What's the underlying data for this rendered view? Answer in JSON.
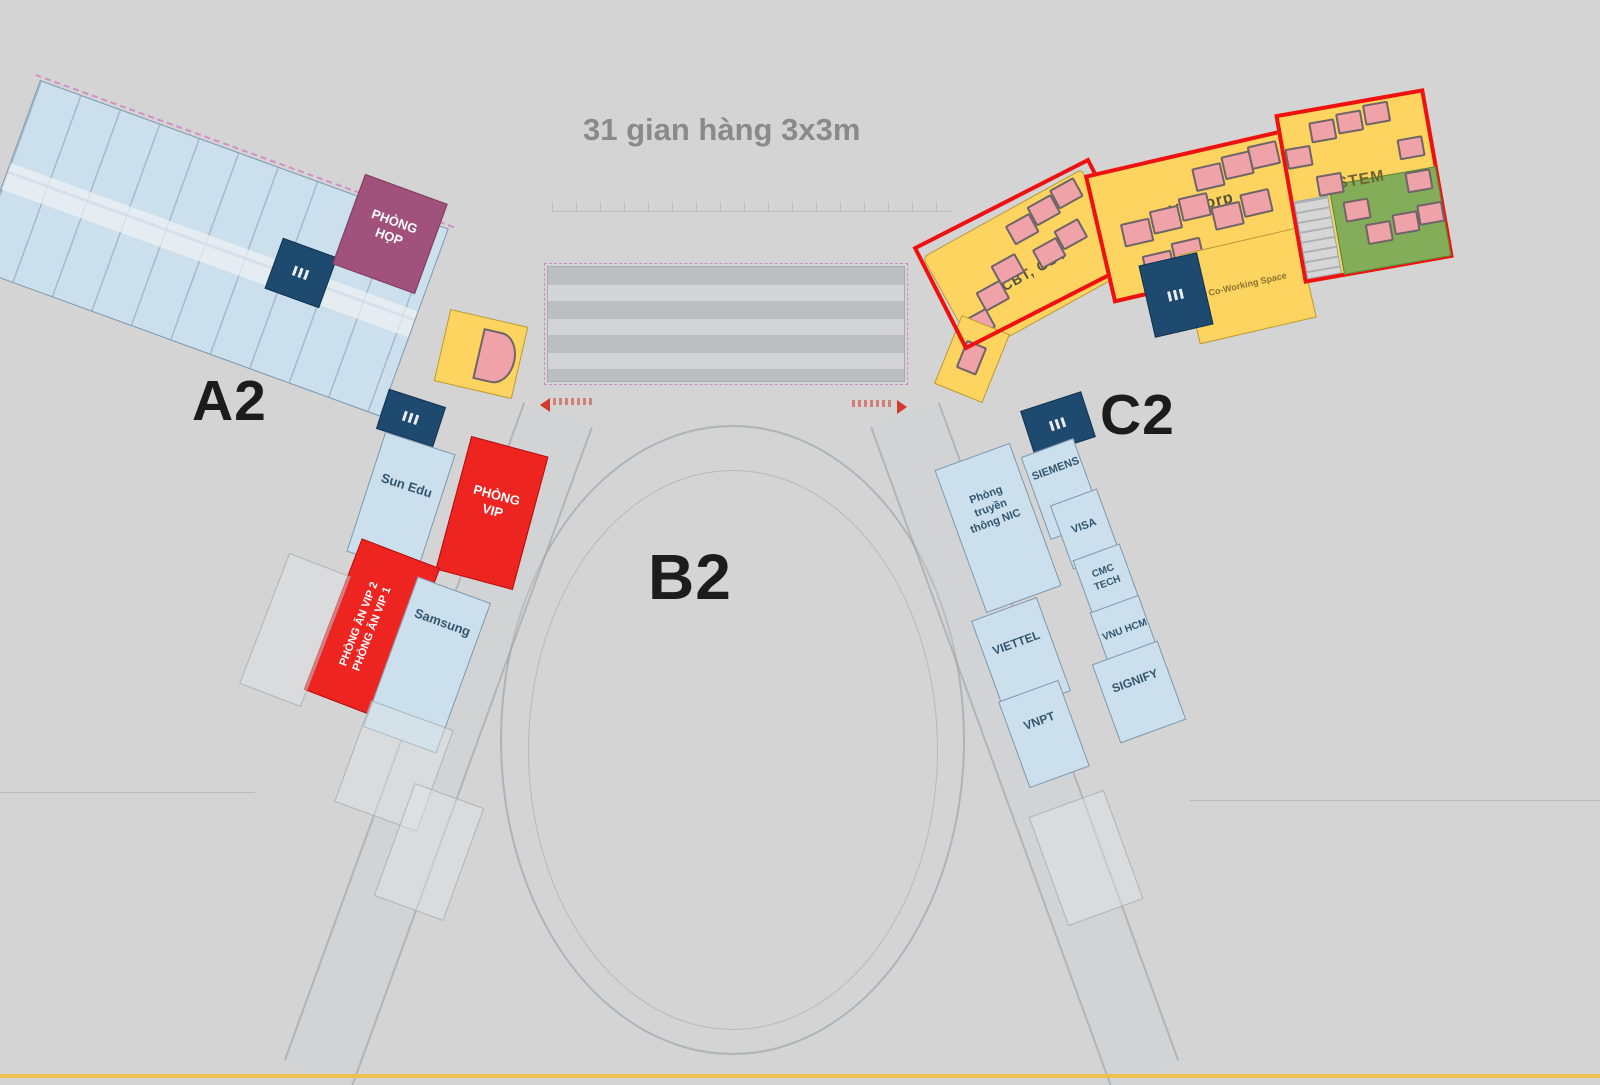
{
  "title": "31 gian hàng 3x3m",
  "zone_labels": {
    "a2": "A2",
    "b2": "B2",
    "c2": "C2"
  },
  "left_wing": {
    "phong_hop": "PHÒNG\nHỌP",
    "sun_edu": "Sun Edu",
    "phong_vip": "PHÒNG\nVIP",
    "phong_an_vip_line1": "PHÒNG ĂN VIP 2",
    "phong_an_vip_line2": "PHÒNG ĂN VIP 1",
    "samsung": "Samsung"
  },
  "right_wing": {
    "tcbt_gdt": "TCBT, GDT",
    "vccorp": "VCCorp",
    "coworking": "Co-Working Space",
    "stem": "STEM",
    "siemens": "SIEMENS",
    "nic": "Phòng\ntruyền\nthông NIC",
    "visa": "VISA",
    "cmc_tech": "CMC\nTECH",
    "vnu_hcm": "VNU HCM",
    "viettel": "VIETTEL",
    "vnpt": "VNPT",
    "signify": "SIGNIFY"
  },
  "colors": {
    "background": "#d4d4d4",
    "booth_pink": "#efa3a8",
    "highlight_red_outline": "#ee1111",
    "block_yellow": "#fcd45f",
    "block_green": "#83ad59",
    "block_navy": "#1f4a70",
    "block_purple": "#a0517c",
    "block_red": "#ee2421",
    "room_blue": "#cbdfec",
    "bottom_strip": "#edc150"
  }
}
